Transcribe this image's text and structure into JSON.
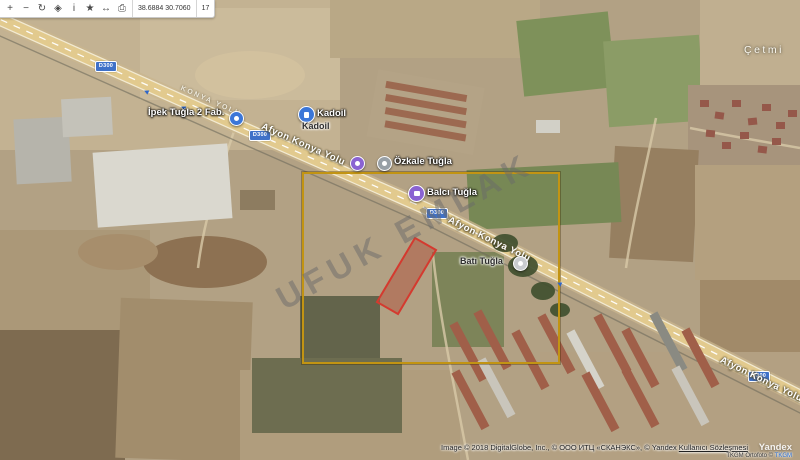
{
  "toolbar": {
    "icons": [
      {
        "name": "zoom-in-icon",
        "glyph": "+"
      },
      {
        "name": "zoom-out-icon",
        "glyph": "−"
      },
      {
        "name": "refresh-icon",
        "glyph": "↻"
      },
      {
        "name": "navigate-icon",
        "glyph": "◈"
      },
      {
        "name": "info-icon",
        "glyph": "i"
      },
      {
        "name": "bookmark-icon",
        "glyph": "★"
      },
      {
        "name": "measure-icon",
        "glyph": "↔"
      },
      {
        "name": "print-icon",
        "glyph": "⎙"
      }
    ],
    "coordinates": "38.6884  30.7060",
    "zoom_level": "17"
  },
  "map": {
    "watermark": "UFUK EMLAK",
    "road_shield": "D300",
    "road_name": "Afyon Konya Yolu",
    "road_name_caps": "KONYA YOLU",
    "place_label": "Çetmi",
    "pois": {
      "ipek": {
        "label": "İpek Tuğla 2 Fab."
      },
      "kadoil": {
        "label": "Kadoil",
        "sublabel": "Kadoil"
      },
      "ozkale": {
        "label": "Özkale Tuğla"
      },
      "balci": {
        "label": "Balcı Tuğla"
      },
      "bati": {
        "label": "Batı Tuğla"
      }
    },
    "overlay": {
      "selection_rect_color": "#c29413",
      "parcel_outline_color": "#d43a2f"
    }
  },
  "attribution": {
    "line1": "Image © 2018 DigitalGlobe, Inc., © ООО ИТЦ «СКАНЭКС», © Yandex",
    "terms_link": "Kullanıcı Sözleşmesi",
    "logo": "Yandex",
    "line2_text": "TKGM Ortofoto ©",
    "line2_link": "TKGM"
  }
}
